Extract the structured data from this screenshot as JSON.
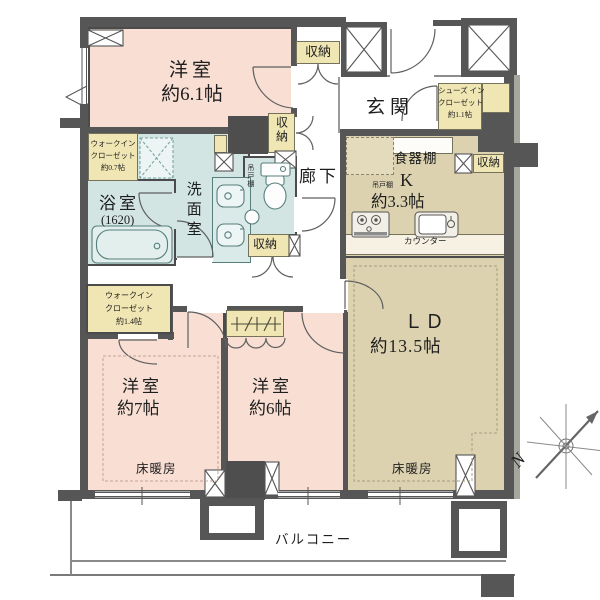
{
  "plan": {
    "kind": "apartment-floor-plan",
    "rooms": {
      "bedroom_61": {
        "name": "洋室",
        "size": "約6.1帖"
      },
      "bedroom_7": {
        "name": "洋室",
        "size": "約7帖"
      },
      "bedroom_6": {
        "name": "洋室",
        "size": "約6帖"
      },
      "living_dining": {
        "name": "ＬＤ",
        "size": "約13.5帖"
      },
      "kitchen": {
        "name": "K",
        "size": "約3.3帖"
      },
      "bath": {
        "name": "浴室",
        "size": "(1620)"
      },
      "washroom": {
        "name": "洗面室"
      },
      "entrance": {
        "name": "玄関"
      },
      "hallway": {
        "name": "廊下"
      },
      "balcony": {
        "name": "バルコニー"
      },
      "wic_07": {
        "line1": "ウォークイン",
        "line2": "クローゼット",
        "line3": "約0.7帖"
      },
      "wic_14": {
        "line1": "ウォークイン",
        "line2": "クローゼット",
        "line3": "約1.4帖"
      },
      "sic": {
        "line1": "シューズ イン",
        "line2": "クローゼット",
        "line3": "約1.1帖"
      }
    },
    "fixtures": {
      "storage": "収納",
      "hanging_cupboard": "吊戸棚",
      "cupboard": "食器棚",
      "counter": "カウンター",
      "floor_heating": "床暖房"
    },
    "compass": {
      "north": "N"
    },
    "colors": {
      "room_pink": "#f8ded3",
      "ld_beige": "#dcd2b0",
      "closet_yellow": "#f0e6b3",
      "wet_teal": "#d3e5e3",
      "wall_gray": "#565656"
    }
  }
}
